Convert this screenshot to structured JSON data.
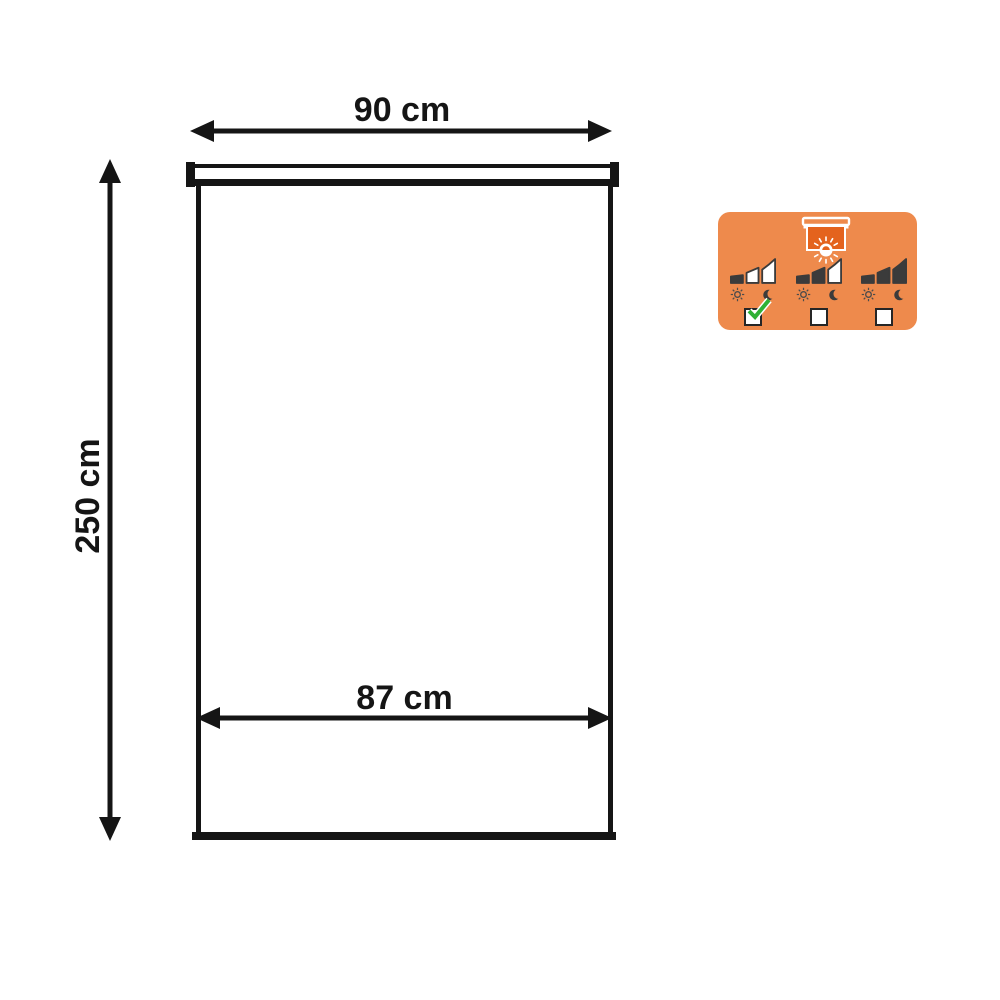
{
  "colors": {
    "line": "#151515",
    "badge_bg": "#EE8A4C",
    "fabric": "#E4631D",
    "bar": "#3B3B3B",
    "check": "#2FB135"
  },
  "diagram": {
    "top_width_label": "90 cm",
    "height_label": "250 cm",
    "inner_width_label": "87 cm"
  },
  "badge": {
    "blind_icon": "roller-blind-with-sun-icon",
    "options": [
      {
        "filled_bars": 1,
        "total_bars": 3,
        "checked": true
      },
      {
        "filled_bars": 2,
        "total_bars": 3,
        "checked": false
      },
      {
        "filled_bars": 3,
        "total_bars": 3,
        "checked": false
      }
    ]
  }
}
